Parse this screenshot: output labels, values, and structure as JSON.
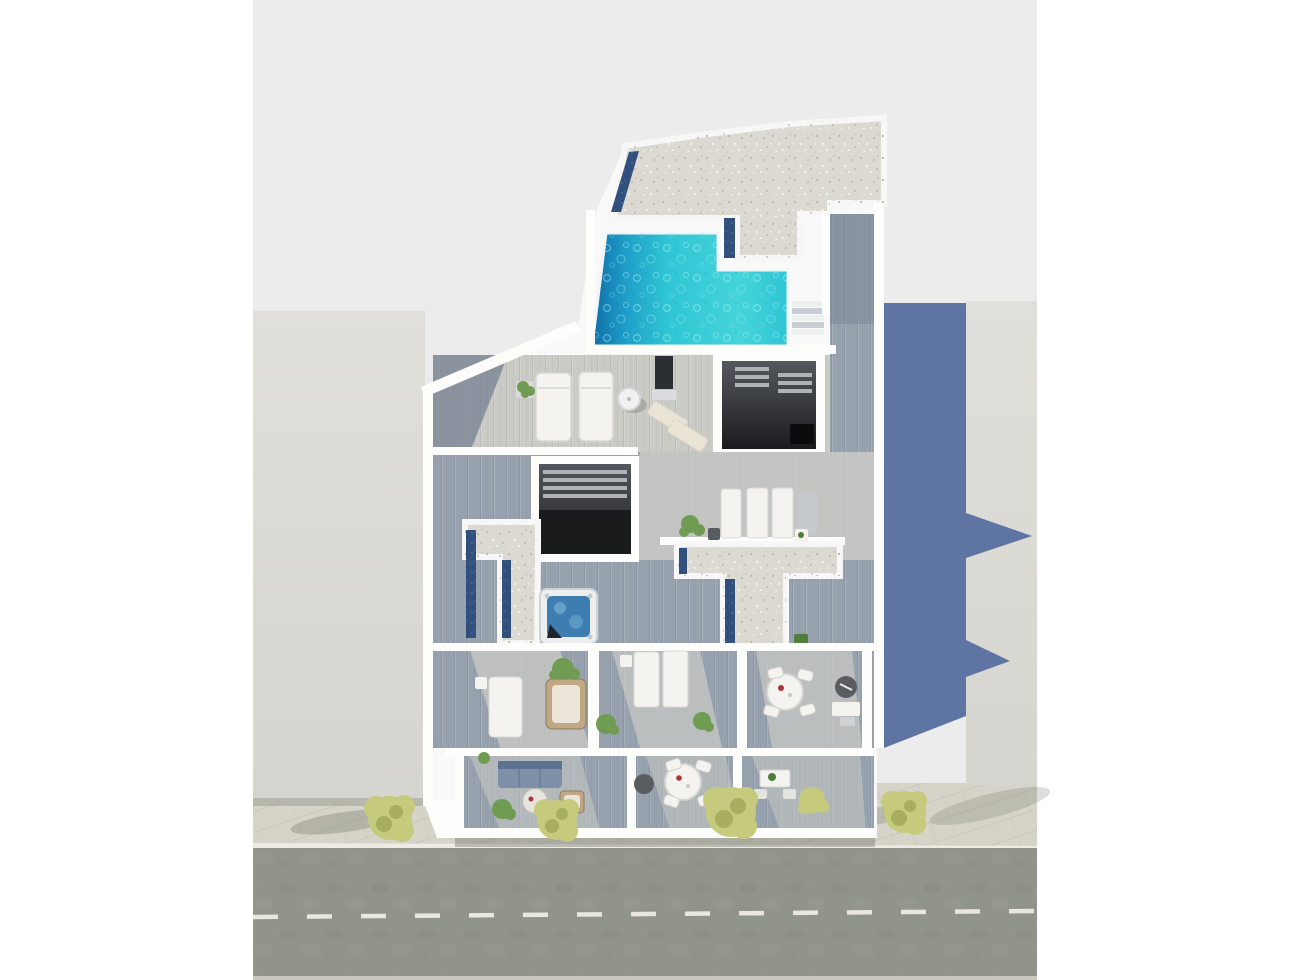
{
  "meta": {
    "description": "Aerial 3D architectural render of a white rooftop apartment level with L-shaped pool, terraces and street below",
    "view": "top-down axonometric",
    "text_on_screen": "none"
  },
  "colors": {
    "page_bg": "#ffffff",
    "canvas": "#ececec",
    "neighbor_roof": "#dcdbd6",
    "shadow_blue": "#5e75a3",
    "sidewalk": "#d6d3c9",
    "curb_line": "#edebe3",
    "road": "#90948a",
    "road_line": "#e9e7df",
    "road_bottom": "#c9c6bd",
    "tree_green": "#c5ca7d",
    "tree_green_dark": "#a8ae60",
    "tree_shadow": "#5f6257",
    "wall_white": "#f8f9f8",
    "wall_bright": "#fdfdfc",
    "gravel": "#dcd9d2",
    "navy_skylight": "#32507e",
    "deck_pale": "#cbcbc6",
    "deck_mid": "#98a2ae",
    "deck_dark": "#7a8495",
    "pool_deep": "#0f6da9",
    "pool_mid": "#1e9ec8",
    "pool_teal": "#2fc5d5",
    "pool_bright": "#45d4da",
    "void_top": "#54585e",
    "void_bottom": "#1a1b1d",
    "stair_tread": "#aeb3b8",
    "black_box": "#0b0c0d",
    "panel_dark": "#2b2e32",
    "hot_tub_shell": "#eceef0",
    "hot_tub_water": "#3d7db1",
    "hot_tub_dark": "#20242a",
    "furniture_white": "#f4f3f0",
    "furniture_shadow": "#d8d8d3",
    "furniture_beige": "#eae4d6",
    "wicker": "#c0a884",
    "wicker_inner": "#ece6da",
    "sofa_blue": "#7d90a8",
    "sofa_blue_dark": "#5d7190",
    "table_dark": "#595d62",
    "plant_green": "#6f9c52",
    "plant_dark": "#4f7d3a",
    "pot_gray": "#d9dadb",
    "red_accent": "#b03434"
  },
  "scene": {
    "street": {
      "lanes": 2,
      "marking": "white dashed center line",
      "sidewalk_trees": 4
    },
    "left_neighbor": "flat light-gray roof block",
    "right_neighbor": "light-gray block with large blue-gray cast shadow",
    "main_building": {
      "gravel_roof": "speckled gravel flat roof with navy skylight strips",
      "pool": "L-shaped turquoise pool, deep blue at left end, white rim, side steps",
      "stairwell_voids": 2,
      "gravel_canopies": 2,
      "hot_tub": "square white jacuzzi with blue water",
      "roof_terrace_furniture": [
        "2 white sunbeds",
        "closed parasol",
        "2 beige deck chairs",
        "dark shower panel",
        "potted plant"
      ],
      "mid_deck_furniture": [
        "3 white sunbeds",
        "1 gray sunbed",
        "2 side tables",
        "potted plants"
      ],
      "rooms_furniture": [
        "sunbed + wicker lounger + side table",
        "2 sunbeds + side tables",
        "round dining table with 4 chairs + wicker side table + desk"
      ],
      "terraces_furniture": [
        "blue sofa + round coffee table + wicker chair",
        "round dining table with 4 chairs + wicker side table",
        "small table with 2 chairs"
      ],
      "plants": "green shrubs on decks, yellow-green bushes along sidewalk"
    }
  }
}
